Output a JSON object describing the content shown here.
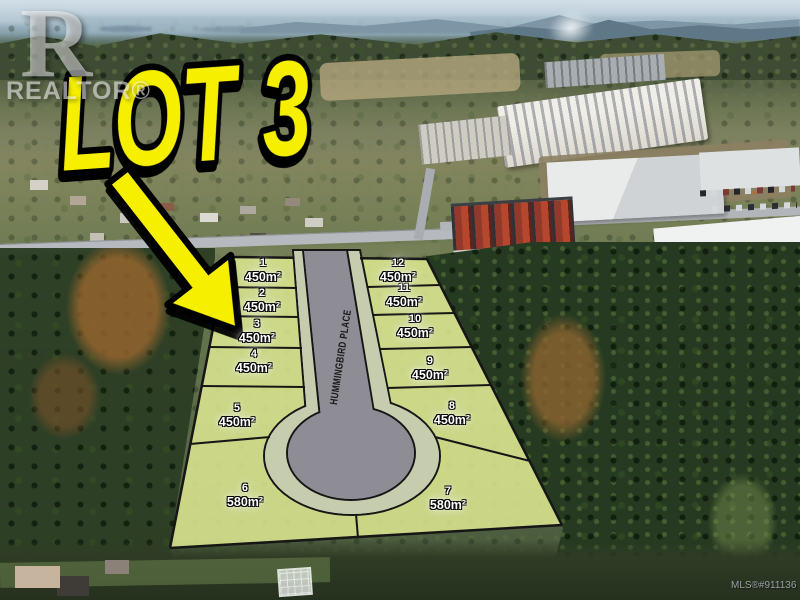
{
  "title_overlay": {
    "text": "LOT 3"
  },
  "watermark": {
    "logo_letter": "R",
    "logo_text": "REALTOR®"
  },
  "mls_label": "MLS®#911136",
  "street": {
    "name": "HUMMINGBIRD PLACE"
  },
  "plan": {
    "lots": [
      {
        "number": "1",
        "area": "450m²"
      },
      {
        "number": "2",
        "area": "450m²"
      },
      {
        "number": "3",
        "area": "450m²"
      },
      {
        "number": "4",
        "area": "450m²"
      },
      {
        "number": "5",
        "area": "450m²"
      },
      {
        "number": "6",
        "area": "580m²"
      },
      {
        "number": "7",
        "area": "580m²"
      },
      {
        "number": "8",
        "area": "450m²"
      },
      {
        "number": "9",
        "area": "450m²"
      },
      {
        "number": "10",
        "area": "450m²"
      },
      {
        "number": "11",
        "area": "450m²"
      },
      {
        "number": "12",
        "area": "450m²"
      }
    ]
  },
  "colors": {
    "lot_fill": "#dce791",
    "road_gray": "#8e8c94",
    "road_band_sage": "#c6cdae",
    "highlight_yellow": "#f6ef00",
    "outline_black": "#161616",
    "label_white": "#ffffff"
  }
}
